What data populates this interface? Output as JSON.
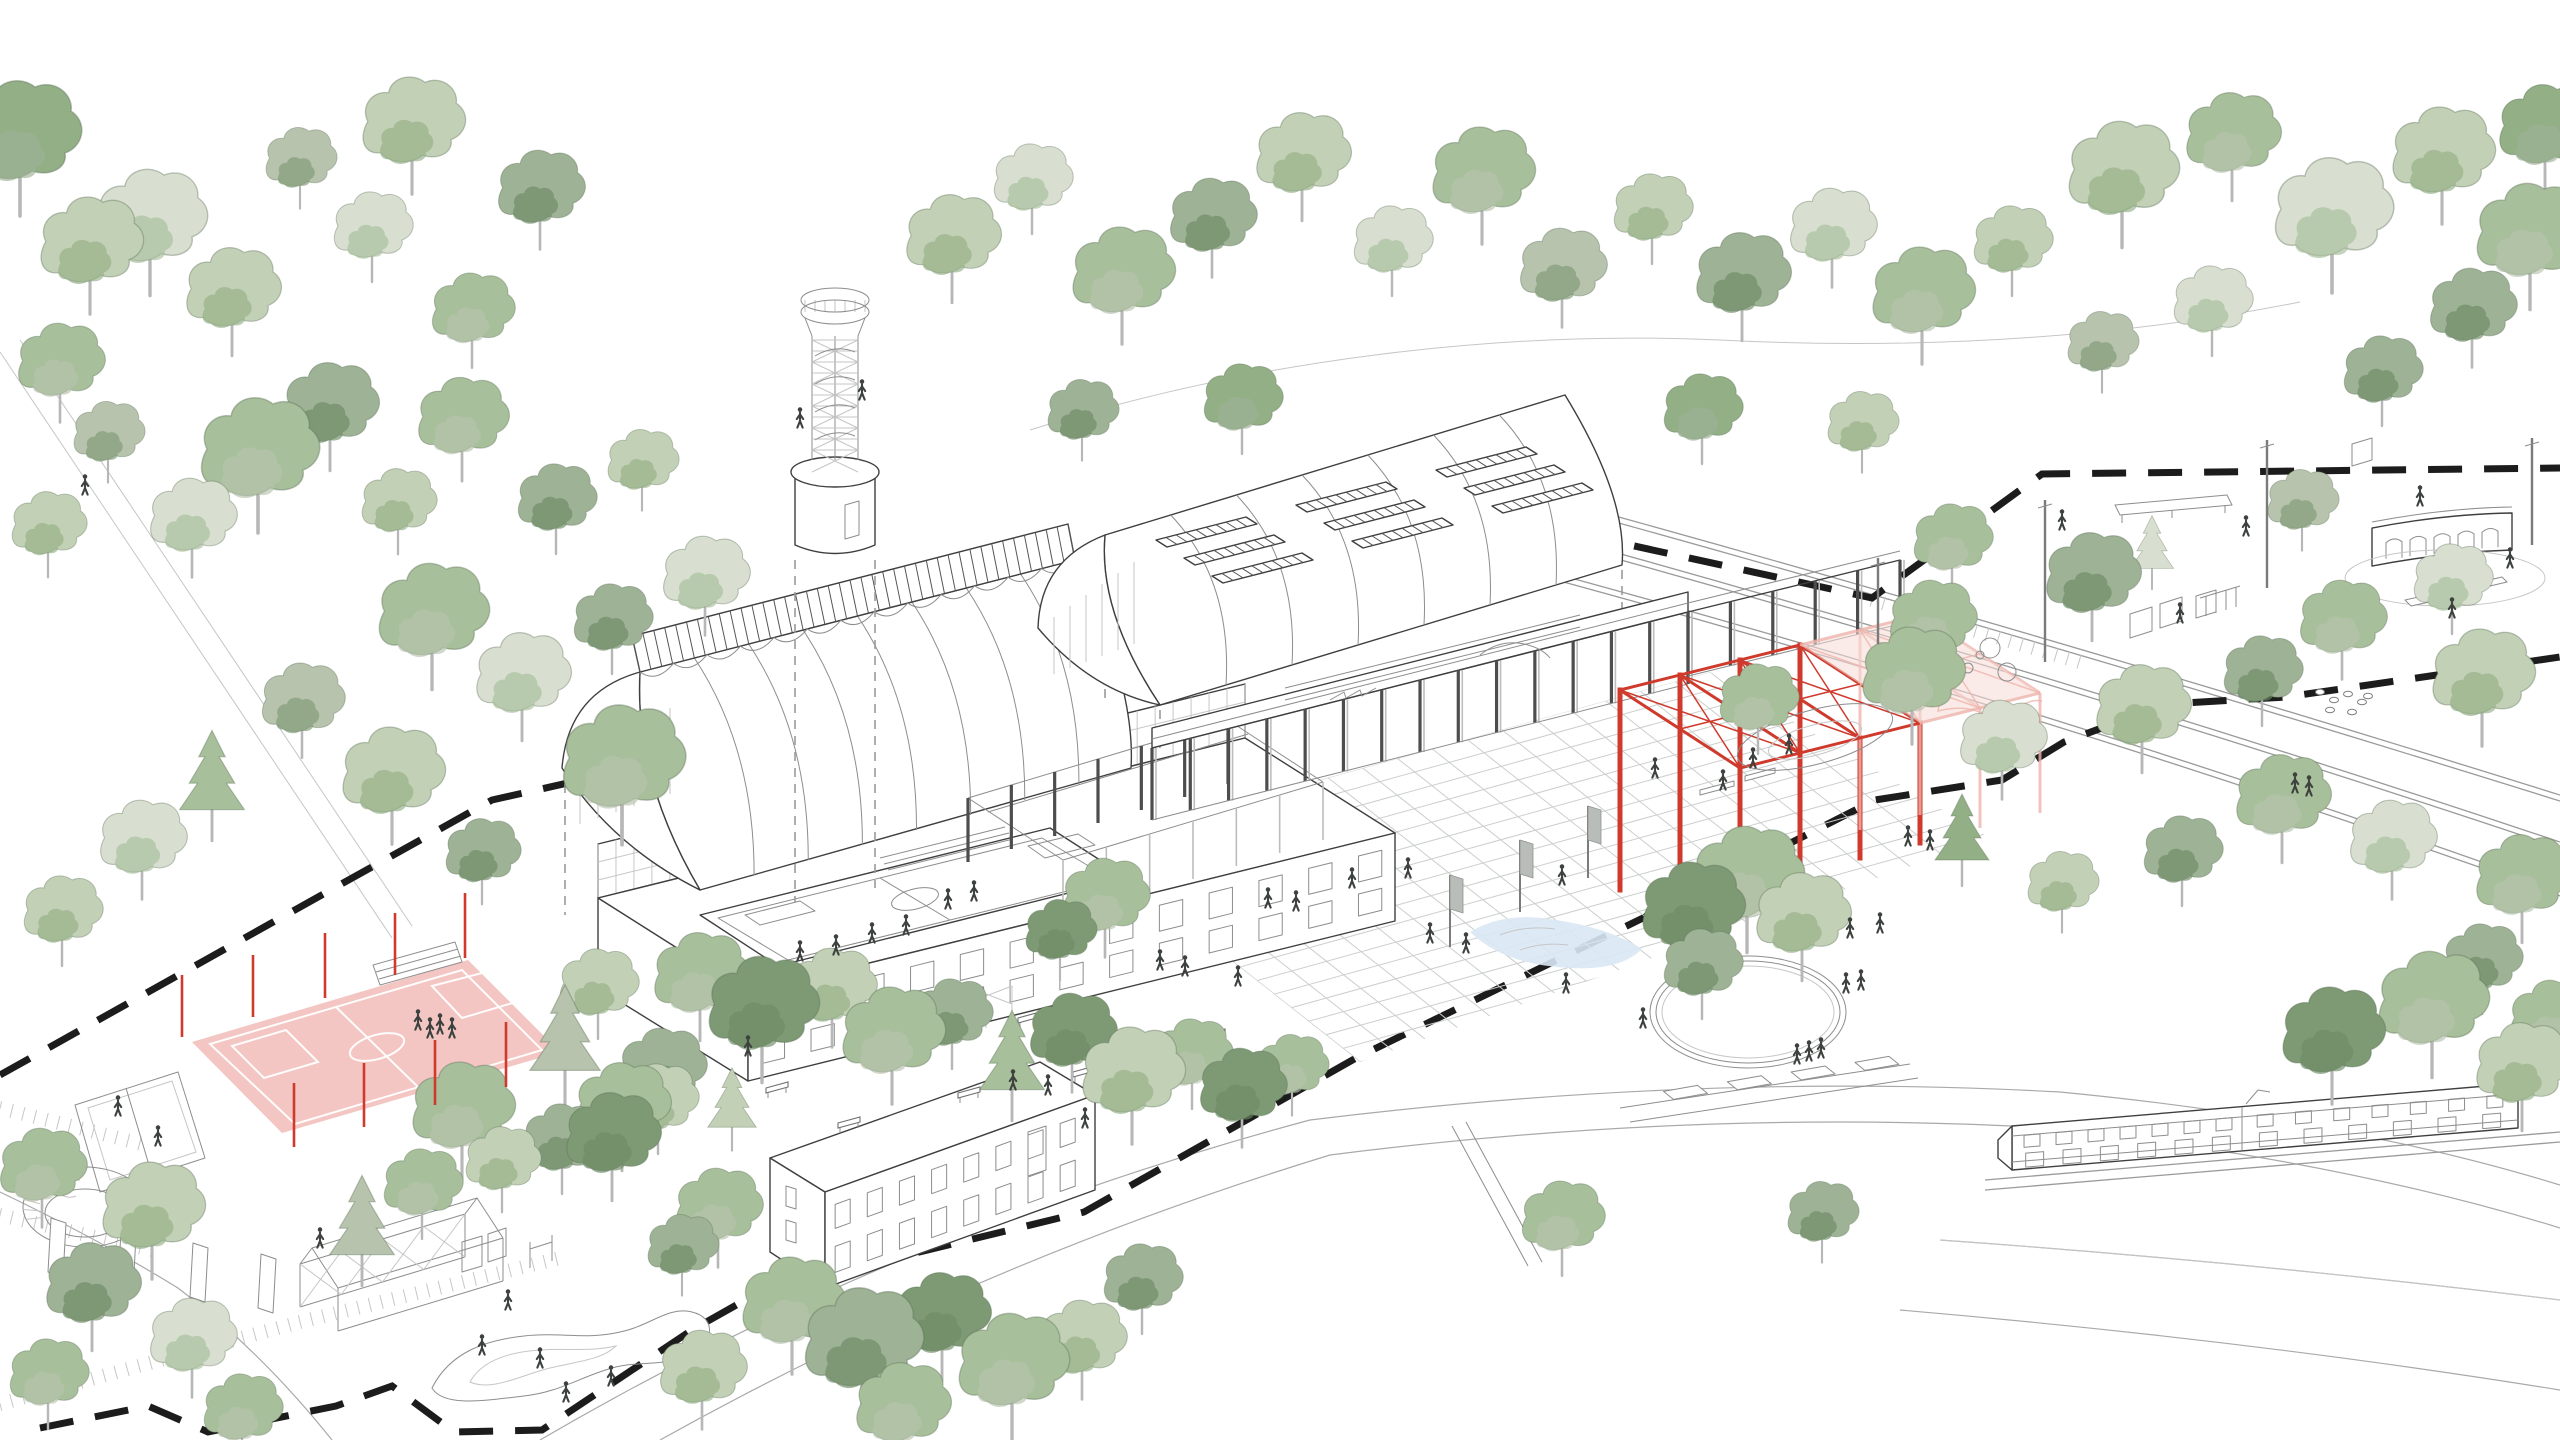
{
  "palette": {
    "ink": "#3f3f3f",
    "ink_light": "#8d8d8d",
    "ink_faint": "#c6c6c6",
    "boundary": "#1c1c1c",
    "red": "#cf3a2d",
    "pink_stroke": "#edb4ab",
    "pink_fill": "#f6dad5",
    "court_fill": "#f2c0bc",
    "water": "#d9e8f4",
    "person": "#3d423e",
    "flag": "#b9bdb9",
    "greens": [
      "#d8dfd0",
      "#c2d0b6",
      "#a8bf9b",
      "#93af86",
      "#b7c3ad",
      "#9eb296",
      "#7e9a74",
      "#6d8a65"
    ]
  },
  "scene": {
    "trees": [
      [
        20,
        165,
        1.5,
        3,
        0
      ],
      [
        90,
        270,
        1.3,
        1,
        0
      ],
      [
        60,
        385,
        1.1,
        2,
        0
      ],
      [
        150,
        248,
        1.4,
        0,
        0
      ],
      [
        232,
        315,
        1.2,
        1,
        0
      ],
      [
        258,
        482,
        1.5,
        2,
        0
      ],
      [
        192,
        540,
        1.1,
        0,
        0
      ],
      [
        48,
        545,
        0.95,
        1,
        0
      ],
      [
        330,
        430,
        1.2,
        5,
        0
      ],
      [
        372,
        248,
        1.0,
        0,
        0
      ],
      [
        300,
        178,
        0.9,
        4,
        0
      ],
      [
        412,
        150,
        1.3,
        1,
        0
      ],
      [
        540,
        212,
        1.1,
        5,
        0
      ],
      [
        472,
        332,
        1.05,
        2,
        0
      ],
      [
        108,
        452,
        0.9,
        4,
        0
      ],
      [
        398,
        522,
        0.95,
        1,
        0
      ],
      [
        432,
        642,
        1.4,
        2,
        0
      ],
      [
        522,
        700,
        1.2,
        0,
        0
      ],
      [
        612,
        640,
        1.0,
        5,
        0
      ],
      [
        392,
        800,
        1.3,
        1,
        0
      ],
      [
        302,
        722,
        1.05,
        4,
        0
      ],
      [
        212,
        800,
        1.2,
        2,
        1
      ],
      [
        142,
        862,
        1.1,
        0,
        0
      ],
      [
        62,
        932,
        1.0,
        1,
        0
      ],
      [
        482,
        872,
        0.95,
        5,
        0
      ],
      [
        622,
        792,
        1.55,
        2,
        0
      ],
      [
        705,
        598,
        1.1,
        0,
        0
      ],
      [
        556,
        520,
        1.0,
        5,
        0
      ],
      [
        462,
        442,
        1.15,
        2,
        0
      ],
      [
        642,
        480,
        0.9,
        1,
        0
      ],
      [
        952,
        262,
        1.2,
        1,
        0
      ],
      [
        1032,
        200,
        1.0,
        0,
        0
      ],
      [
        1122,
        300,
        1.3,
        2,
        0
      ],
      [
        1212,
        240,
        1.1,
        5,
        0
      ],
      [
        1302,
        180,
        1.2,
        1,
        0
      ],
      [
        1392,
        262,
        1.0,
        0,
        0
      ],
      [
        1482,
        200,
        1.3,
        2,
        0
      ],
      [
        1562,
        290,
        1.1,
        4,
        0
      ],
      [
        1652,
        230,
        1.0,
        1,
        0
      ],
      [
        1742,
        300,
        1.2,
        5,
        0
      ],
      [
        1832,
        250,
        1.1,
        0,
        0
      ],
      [
        1922,
        320,
        1.3,
        2,
        0
      ],
      [
        2012,
        262,
        1.0,
        1,
        0
      ],
      [
        1082,
        430,
        0.9,
        5,
        0
      ],
      [
        1242,
        420,
        1.0,
        3,
        0
      ],
      [
        1702,
        430,
        1.0,
        3,
        0
      ],
      [
        1862,
        442,
        0.9,
        1,
        0
      ],
      [
        2122,
        200,
        1.4,
        1,
        0
      ],
      [
        2232,
        160,
        1.2,
        2,
        0
      ],
      [
        2332,
        242,
        1.5,
        0,
        0
      ],
      [
        2442,
        180,
        1.3,
        1,
        0
      ],
      [
        2530,
        262,
        1.4,
        2,
        0
      ],
      [
        2472,
        330,
        1.1,
        5,
        0
      ],
      [
        2212,
        322,
        1.0,
        0,
        0
      ],
      [
        2545,
        152,
        1.2,
        3,
        0
      ],
      [
        2102,
        362,
        0.9,
        4,
        0
      ],
      [
        2382,
        392,
        1.0,
        5,
        0
      ],
      [
        1952,
        560,
        1.0,
        2,
        0
      ],
      [
        2092,
        600,
        1.2,
        5,
        0
      ],
      [
        1912,
        700,
        1.3,
        2,
        0
      ],
      [
        2002,
        762,
        1.1,
        0,
        0
      ],
      [
        2142,
        732,
        1.2,
        1,
        0
      ],
      [
        2262,
        692,
        1.0,
        5,
        0
      ],
      [
        2342,
        642,
        1.1,
        2,
        0
      ],
      [
        2452,
        600,
        1.0,
        0,
        0
      ],
      [
        2482,
        702,
        1.3,
        1,
        0
      ],
      [
        2282,
        822,
        1.2,
        2,
        0
      ],
      [
        2182,
        872,
        1.0,
        5,
        0
      ],
      [
        2392,
        862,
        1.1,
        0,
        0
      ],
      [
        2522,
        902,
        1.2,
        2,
        0
      ],
      [
        2062,
        902,
        0.9,
        1,
        0
      ],
      [
        1962,
        852,
        1.0,
        3,
        1
      ],
      [
        2302,
        520,
        0.9,
        4,
        0
      ],
      [
        2152,
        562,
        0.8,
        0,
        1
      ],
      [
        1692,
        935,
        1.3,
        6,
        0
      ],
      [
        1747,
        905,
        1.4,
        2,
        0
      ],
      [
        1802,
        940,
        1.2,
        1,
        0
      ],
      [
        1702,
        985,
        1.0,
        5,
        0
      ],
      [
        700,
        1000,
        1.2,
        2,
        0
      ],
      [
        762,
        1035,
        1.4,
        6,
        0
      ],
      [
        832,
        1010,
        1.1,
        1,
        0
      ],
      [
        892,
        1060,
        1.3,
        2,
        0
      ],
      [
        952,
        1035,
        1.0,
        5,
        0
      ],
      [
        1012,
        1080,
        1.2,
        2,
        1
      ],
      [
        1072,
        1055,
        1.1,
        6,
        0
      ],
      [
        1132,
        1100,
        1.3,
        1,
        0
      ],
      [
        1192,
        1075,
        1.0,
        2,
        0
      ],
      [
        662,
        1090,
        1.1,
        5,
        0
      ],
      [
        622,
        1130,
        1.2,
        2,
        0
      ],
      [
        732,
        1120,
        0.9,
        1,
        1
      ],
      [
        1242,
        1110,
        1.1,
        6,
        0
      ],
      [
        1292,
        1085,
        0.9,
        2,
        0
      ],
      [
        598,
        1005,
        1.0,
        1,
        0
      ],
      [
        1105,
        920,
        1.1,
        2,
        0
      ],
      [
        1060,
        950,
        0.9,
        6,
        0
      ],
      [
        792,
        1330,
        1.3,
        2,
        0
      ],
      [
        862,
        1372,
        1.5,
        5,
        0
      ],
      [
        942,
        1340,
        1.2,
        6,
        0
      ],
      [
        1012,
        1392,
        1.4,
        2,
        0
      ],
      [
        1082,
        1362,
        1.1,
        1,
        0
      ],
      [
        902,
        1430,
        1.2,
        2,
        0
      ],
      [
        1142,
        1300,
        1.0,
        5,
        0
      ],
      [
        702,
        1392,
        1.1,
        1,
        0
      ],
      [
        718,
        1230,
        1.1,
        2,
        0
      ],
      [
        682,
        1265,
        0.9,
        5,
        0
      ],
      [
        42,
        1190,
        1.1,
        2,
        0
      ],
      [
        152,
        1235,
        1.3,
        1,
        0
      ],
      [
        92,
        1310,
        1.2,
        5,
        0
      ],
      [
        48,
        1395,
        1.0,
        2,
        0
      ],
      [
        192,
        1360,
        1.1,
        0,
        0
      ],
      [
        362,
        1245,
        1.2,
        4,
        1
      ],
      [
        422,
        1205,
        1.0,
        2,
        0
      ],
      [
        502,
        1180,
        0.95,
        1,
        0
      ],
      [
        562,
        1160,
        1.0,
        5,
        0
      ],
      [
        242,
        1430,
        1.0,
        2,
        0
      ],
      [
        565,
        1060,
        1.3,
        4,
        1
      ],
      [
        462,
        1135,
        1.3,
        2,
        0
      ],
      [
        612,
        1160,
        1.2,
        6,
        0
      ],
      [
        658,
        1120,
        1.0,
        1,
        0
      ],
      [
        1758,
        720,
        1.0,
        2,
        0
      ],
      [
        1932,
        642,
        1.1,
        2,
        0
      ],
      [
        2332,
        1060,
        1.3,
        6,
        0
      ],
      [
        2432,
        1030,
        1.4,
        2,
        0
      ],
      [
        2522,
        1090,
        1.2,
        1,
        0
      ],
      [
        2482,
        980,
        1.0,
        5,
        0
      ],
      [
        2552,
        1042,
        1.1,
        2,
        0
      ],
      [
        1562,
        1240,
        1.05,
        2,
        0
      ],
      [
        1822,
        1232,
        0.9,
        5,
        0
      ]
    ],
    "people": [
      [
        85,
        487
      ],
      [
        800,
        953
      ],
      [
        836,
        947
      ],
      [
        872,
        935
      ],
      [
        906,
        927
      ],
      [
        948,
        901
      ],
      [
        974,
        893
      ],
      [
        418,
        1022
      ],
      [
        430,
        1030
      ],
      [
        440,
        1026
      ],
      [
        452,
        1030
      ],
      [
        748,
        1048
      ],
      [
        1013,
        1082
      ],
      [
        1048,
        1087
      ],
      [
        1085,
        1120
      ],
      [
        1268,
        900
      ],
      [
        1296,
        903
      ],
      [
        1238,
        978
      ],
      [
        1430,
        935
      ],
      [
        1466,
        945
      ],
      [
        1562,
        877
      ],
      [
        1566,
        985
      ],
      [
        1643,
        1020
      ],
      [
        1850,
        930
      ],
      [
        1880,
        925
      ],
      [
        1908,
        838
      ],
      [
        1930,
        842
      ],
      [
        1797,
        1056
      ],
      [
        1809,
        1053
      ],
      [
        1821,
        1050
      ],
      [
        1846,
        985
      ],
      [
        1861,
        982
      ],
      [
        1753,
        760
      ],
      [
        1789,
        746
      ],
      [
        1723,
        782
      ],
      [
        508,
        1302
      ],
      [
        482,
        1347
      ],
      [
        540,
        1360
      ],
      [
        566,
        1394
      ],
      [
        611,
        1378
      ],
      [
        2295,
        785
      ],
      [
        2309,
        788
      ],
      [
        2420,
        498
      ],
      [
        2180,
        615
      ],
      [
        2246,
        528
      ],
      [
        1160,
        962
      ],
      [
        1185,
        968
      ],
      [
        320,
        1240
      ],
      [
        1655,
        770
      ],
      [
        2510,
        560
      ],
      [
        2452,
        610
      ],
      [
        118,
        1108
      ],
      [
        158,
        1138
      ],
      [
        1352,
        880
      ],
      [
        1408,
        870
      ],
      [
        2062,
        522
      ],
      [
        800,
        420
      ],
      [
        862,
        392
      ]
    ],
    "benches": [
      [
        1030,
        1018
      ],
      [
        1085,
        1072
      ],
      [
        970,
        1093
      ],
      [
        850,
        1123
      ],
      [
        778,
        1088
      ],
      [
        1150,
        1060
      ],
      [
        915,
        1048
      ],
      [
        1215,
        1035
      ]
    ],
    "red_posts": [
      [
        182,
        975,
        1037
      ],
      [
        253,
        955,
        1017
      ],
      [
        325,
        933,
        998
      ],
      [
        395,
        913,
        975
      ],
      [
        465,
        893,
        958
      ],
      [
        294,
        1083,
        1147
      ],
      [
        364,
        1063,
        1127
      ],
      [
        435,
        1040,
        1105
      ],
      [
        506,
        1022,
        1087
      ]
    ],
    "boundary_upper": [
      [
        0,
        1075
      ],
      [
        250,
        935
      ],
      [
        492,
        800
      ],
      [
        706,
        752
      ],
      [
        1070,
        652
      ],
      [
        1616,
        542
      ],
      [
        1872,
        598
      ],
      [
        2042,
        474
      ],
      [
        2560,
        468
      ]
    ],
    "boundary_lower": [
      [
        40,
        1428
      ],
      [
        148,
        1406
      ],
      [
        208,
        1432
      ],
      [
        336,
        1406
      ],
      [
        392,
        1386
      ],
      [
        454,
        1432
      ],
      [
        542,
        1430
      ],
      [
        692,
        1330
      ],
      [
        763,
        1290
      ],
      [
        1084,
        1212
      ],
      [
        1356,
        1058
      ],
      [
        1643,
        918
      ],
      [
        1875,
        800
      ],
      [
        2002,
        780
      ],
      [
        2064,
        742
      ],
      [
        2166,
        704
      ],
      [
        2286,
        697
      ],
      [
        2560,
        657
      ]
    ],
    "louver_groups": [
      [
        1156,
        540
      ],
      [
        1296,
        505
      ],
      [
        1436,
        470
      ]
    ],
    "masts": [
      [
        1878,
        558,
        700
      ],
      [
        2045,
        500,
        662
      ],
      [
        2267,
        440,
        588
      ],
      [
        2532,
        438,
        545
      ]
    ],
    "banner_flags": [
      [
        1450,
        947
      ],
      [
        1520,
        912
      ],
      [
        1588,
        878
      ]
    ],
    "stepping_stones": [
      [
        2320,
        692
      ],
      [
        2334,
        700
      ],
      [
        2348,
        694
      ],
      [
        2362,
        702
      ],
      [
        2330,
        710
      ],
      [
        2352,
        712
      ],
      [
        2368,
        696
      ]
    ],
    "play_circles": [
      [
        1952,
        660,
        5
      ],
      [
        1968,
        668,
        5
      ],
      [
        1940,
        672,
        4
      ],
      [
        1980,
        655,
        4
      ],
      [
        1990,
        648,
        10
      ],
      [
        2007,
        672,
        9
      ]
    ],
    "panels": [
      [
        48,
        1272
      ],
      [
        118,
        1285
      ],
      [
        190,
        1297
      ],
      [
        258,
        1308
      ]
    ],
    "rails": [
      "M1455,472 Q2000,620 2560,795",
      "M1505,522 Q2040,668 2560,842",
      "M1560,575 Q2090,720 2560,890"
    ],
    "roads": [
      "M540,1440 Q900,1230 1310,1120 Q1700,1072 2060,1092 Q2350,1120 2560,1185",
      "M660,1440 Q980,1262 1330,1155 Q1700,1108 2050,1128 Q2340,1160 2560,1228",
      "M0,1192 Q100,1240 178,1288 Q260,1350 332,1440",
      "M1940,1240 Q2250,1262 2560,1300",
      "M1900,1310 Q2250,1340 2560,1390"
    ],
    "footpaths": [
      "M0,352 L392,938",
      "M20,340 L412,926",
      "M1030,430 C1250,360 1500,330 1720,340",
      "M1720,340 C1950,352 2150,332 2300,302"
    ],
    "sleeper_paths": [
      [
        0,
        1108,
        150,
        1146
      ],
      [
        0,
        1215,
        160,
        1252
      ],
      [
        0,
        1404,
        300,
        1322
      ],
      [
        300,
        1322,
        560,
        1258
      ],
      [
        1872,
        600,
        2090,
        665
      ]
    ],
    "pump_track": {
      "cx": 1815,
      "cy": 737,
      "rx": 80,
      "ry": 27,
      "rot": -15
    },
    "deck_oval": {
      "cx": 832,
      "cy": 790,
      "rx": 36,
      "ry": 16,
      "rot": -14
    },
    "pavilion_oval": {
      "cx": 2445,
      "cy": 578,
      "rx": 100,
      "ry": 28
    },
    "train_tracks": [
      "M1985,1180 L2560,1132",
      "M1985,1190 L2560,1142"
    ]
  }
}
